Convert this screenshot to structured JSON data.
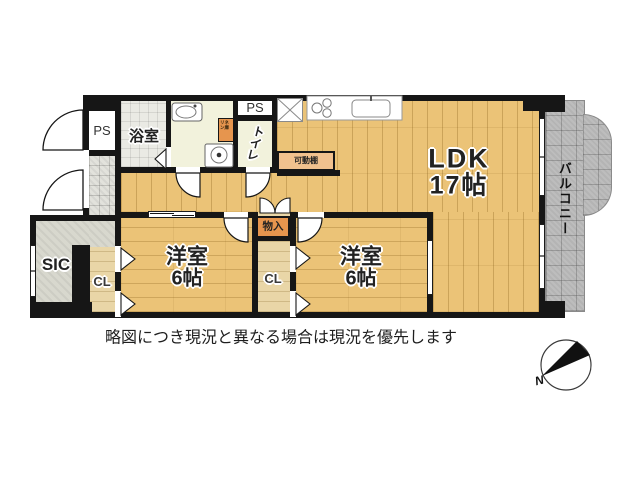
{
  "rooms": {
    "ldk": {
      "name": "LDK",
      "size": "17帖"
    },
    "bedroom1": {
      "name": "洋室",
      "size": "6帖"
    },
    "bedroom2": {
      "name": "洋室",
      "size": "6帖"
    },
    "bath": {
      "name": "浴室"
    },
    "toilet": {
      "name": "トイレ"
    },
    "balcony": {
      "name": "バルコニー"
    },
    "sic": {
      "name": "SIC"
    },
    "closet1": {
      "name": "CL"
    },
    "closet2": {
      "name": "CL"
    },
    "ps_left": {
      "name": "PS"
    },
    "ps_right": {
      "name": "PS"
    },
    "storage": {
      "name": "物入"
    },
    "shelf": {
      "name": "可動棚"
    },
    "linen": {
      "name": "リネン庫"
    }
  },
  "caption": "略図につき現況と異なる場合は現況を優先します",
  "compass": {
    "north_label": "N"
  },
  "colors": {
    "wall": "#161616",
    "wood_floor": "#ebc377",
    "light_wood": "#e9d6a7",
    "accent_orange": "#e6954e",
    "shelf_orange": "#f1c18e",
    "balcony_gray": "#b4b4b4",
    "bath_tile": "#eaeae4",
    "cream_room": "#f2f2dc",
    "sic_gray": "#d8d8ce"
  }
}
